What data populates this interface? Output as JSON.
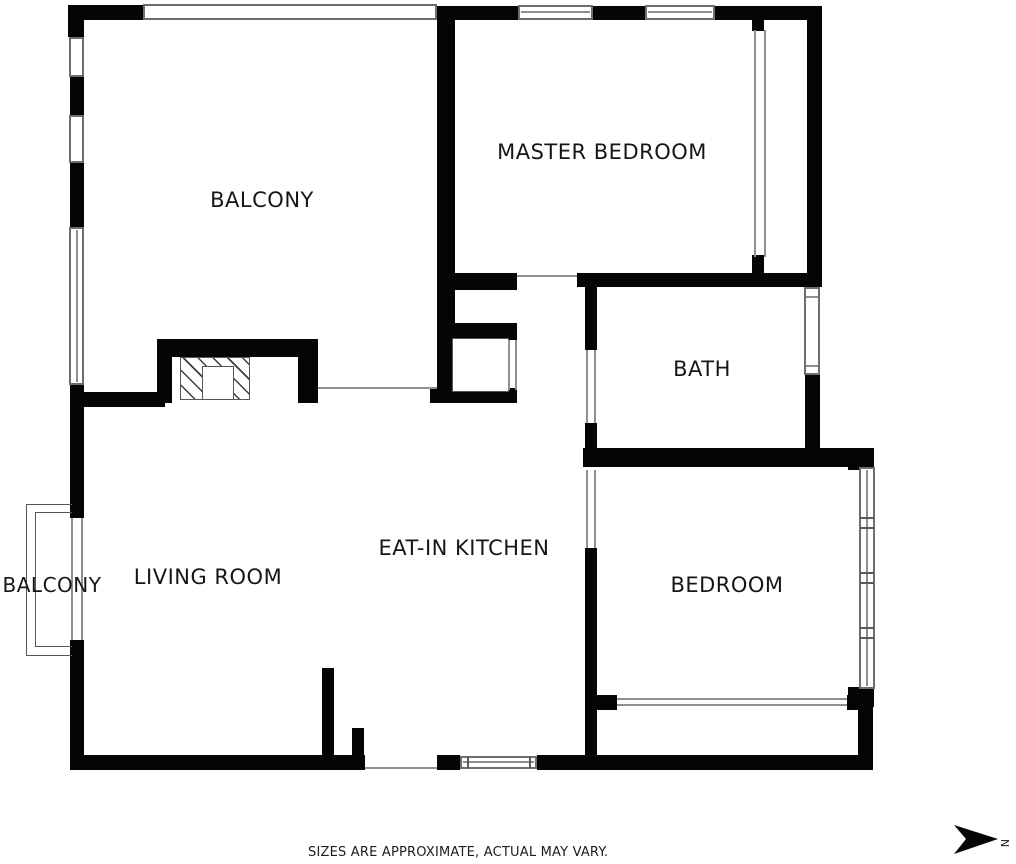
{
  "plan": {
    "rooms": [
      {
        "id": "balcony-main",
        "label": "BALCONY"
      },
      {
        "id": "master-bedroom",
        "label": "MASTER BEDROOM"
      },
      {
        "id": "bath",
        "label": "BATH"
      },
      {
        "id": "living-room",
        "label": "LIVING ROOM"
      },
      {
        "id": "eat-in-kitchen",
        "label": "EAT-IN KITCHEN"
      },
      {
        "id": "bedroom",
        "label": "BEDROOM"
      },
      {
        "id": "balcony-side",
        "label": "BALCONY"
      }
    ],
    "footer": {
      "disclaimer": "SIZES ARE APPROXIMATE, ACTUAL MAY VARY."
    },
    "compass": {
      "label": "N",
      "direction": "right"
    },
    "colors": {
      "wall": "#050505",
      "background": "#ffffff",
      "window_frame": "#6e6e6e",
      "thin_line": "#8f8f8f",
      "text": "#161616"
    }
  }
}
